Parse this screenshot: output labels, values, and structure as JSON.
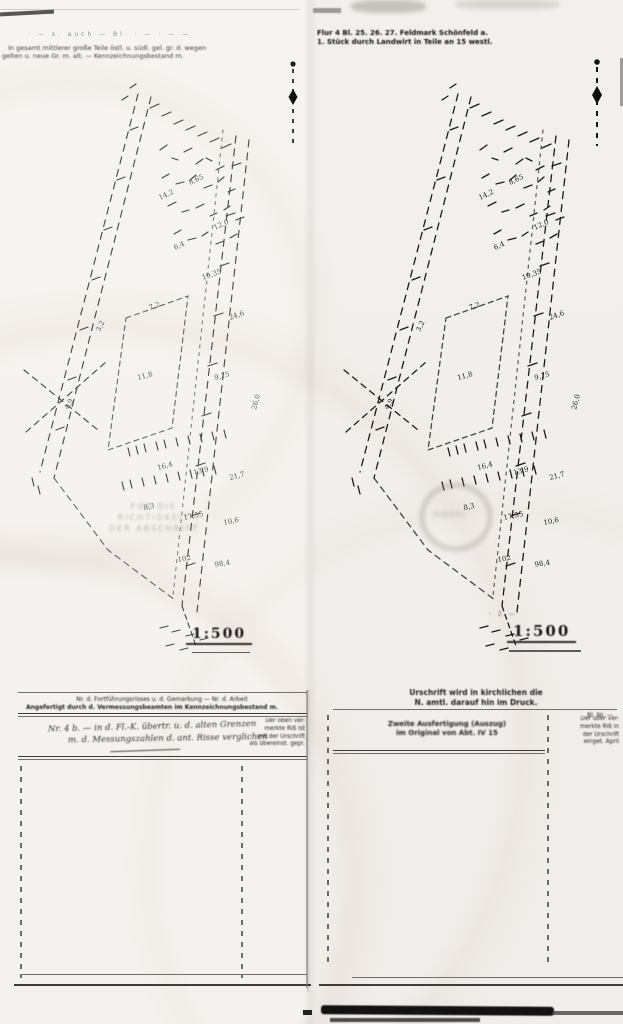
{
  "pages": [
    {
      "side": "left",
      "header": {
        "faint_line": "·  —   s. auch  —  Bl.  ·  —    ·   —    —",
        "line1": "In gesamt mittlerer große Teile östl. u. südl. gel. gr. d. wegen",
        "line2": "gelten u. neue Gr. m. alt. — Kennzeichnungsbestand m."
      },
      "scale_label": "1:500",
      "ghost_stamp": {
        "line1": "FÜR DIE RICHTIGKEIT",
        "line2": "DER ABSCHRIFT"
      },
      "table": {
        "header_line1": "Nr. d. Fortführungsrisses u. d. Gemarkung — Nr. d. Arbeit",
        "header_line2": "Angefertigt durch d. Vermessungsbeamten im Kennzeichnungsbestand m.",
        "entry_line1": "Nr. 4 b. — in d. Fl.-K. übertr. u. d. alten Grenzen",
        "entry_line2": "m. d. Messungszahlen d. ant. Risse verglichen",
        "note_lines": [
          "Der oben ver-",
          "merkte Riß ist",
          "mit der Urschrift",
          "als übereinst. gepr."
        ]
      }
    },
    {
      "side": "right",
      "header": {
        "line1": "Flur 4 Bl. 25. 26. 27. Feldmark Schönfeld a.",
        "line2": "1. Stück durch Landwirt in Teile an 15 westl."
      },
      "scale_label": "1:500",
      "scale_note": "· 2 —",
      "ghost_stamp": {
        "label": "SIEGEL"
      },
      "table": {
        "header_line1": "Urschrift wird in kirchlichen die",
        "header_line2": "N. amtl. darauf hin im Druck.",
        "col_label": "Bl. Nr. —",
        "entry_line1": "Zweite Ausfertigung (Auszug)",
        "entry_line2": "im Original von Abt. IV 15",
        "note_lines": [
          "Der über ver-",
          "merkte Riß in",
          "der Urschrift",
          "einget. April"
        ]
      }
    }
  ],
  "sketch": {
    "labels": [
      {
        "t": "14,2",
        "x": 150,
        "y": 120,
        "r": -25
      },
      {
        "t": "8,65",
        "x": 180,
        "y": 105,
        "r": -25
      },
      {
        "t": "12,0",
        "x": 205,
        "y": 150,
        "r": -25
      },
      {
        "t": "6,4",
        "x": 165,
        "y": 170,
        "r": -25
      },
      {
        "t": "19,35",
        "x": 193,
        "y": 200,
        "r": -20
      },
      {
        "t": "7,2",
        "x": 140,
        "y": 230,
        "r": -20
      },
      {
        "t": "24,6",
        "x": 220,
        "y": 240,
        "r": -20
      },
      {
        "t": "11,8",
        "x": 128,
        "y": 300,
        "r": -15
      },
      {
        "t": "9,15",
        "x": 205,
        "y": 300,
        "r": -15
      },
      {
        "t": "3,2",
        "x": 90,
        "y": 252,
        "r": -65
      },
      {
        "t": "4,9",
        "x": 58,
        "y": 330,
        "r": -60
      },
      {
        "t": "26,0",
        "x": 246,
        "y": 330,
        "r": -75
      },
      {
        "t": "16,4",
        "x": 148,
        "y": 390,
        "r": -15
      },
      {
        "t": "13,9",
        "x": 184,
        "y": 395,
        "r": -15
      },
      {
        "t": "21,7",
        "x": 220,
        "y": 400,
        "r": -15
      },
      {
        "t": "8,3",
        "x": 134,
        "y": 430,
        "r": -12
      },
      {
        "t": "17,55",
        "x": 174,
        "y": 440,
        "r": -12
      },
      {
        "t": "10,6",
        "x": 214,
        "y": 445,
        "r": -12
      },
      {
        "t": "102",
        "x": 168,
        "y": 482,
        "r": -10
      },
      {
        "t": "98,4",
        "x": 205,
        "y": 487,
        "r": -10
      }
    ]
  },
  "colors": {
    "paper": "#f6f4f0",
    "ink": "#222222",
    "ghost": "#8a8178"
  }
}
